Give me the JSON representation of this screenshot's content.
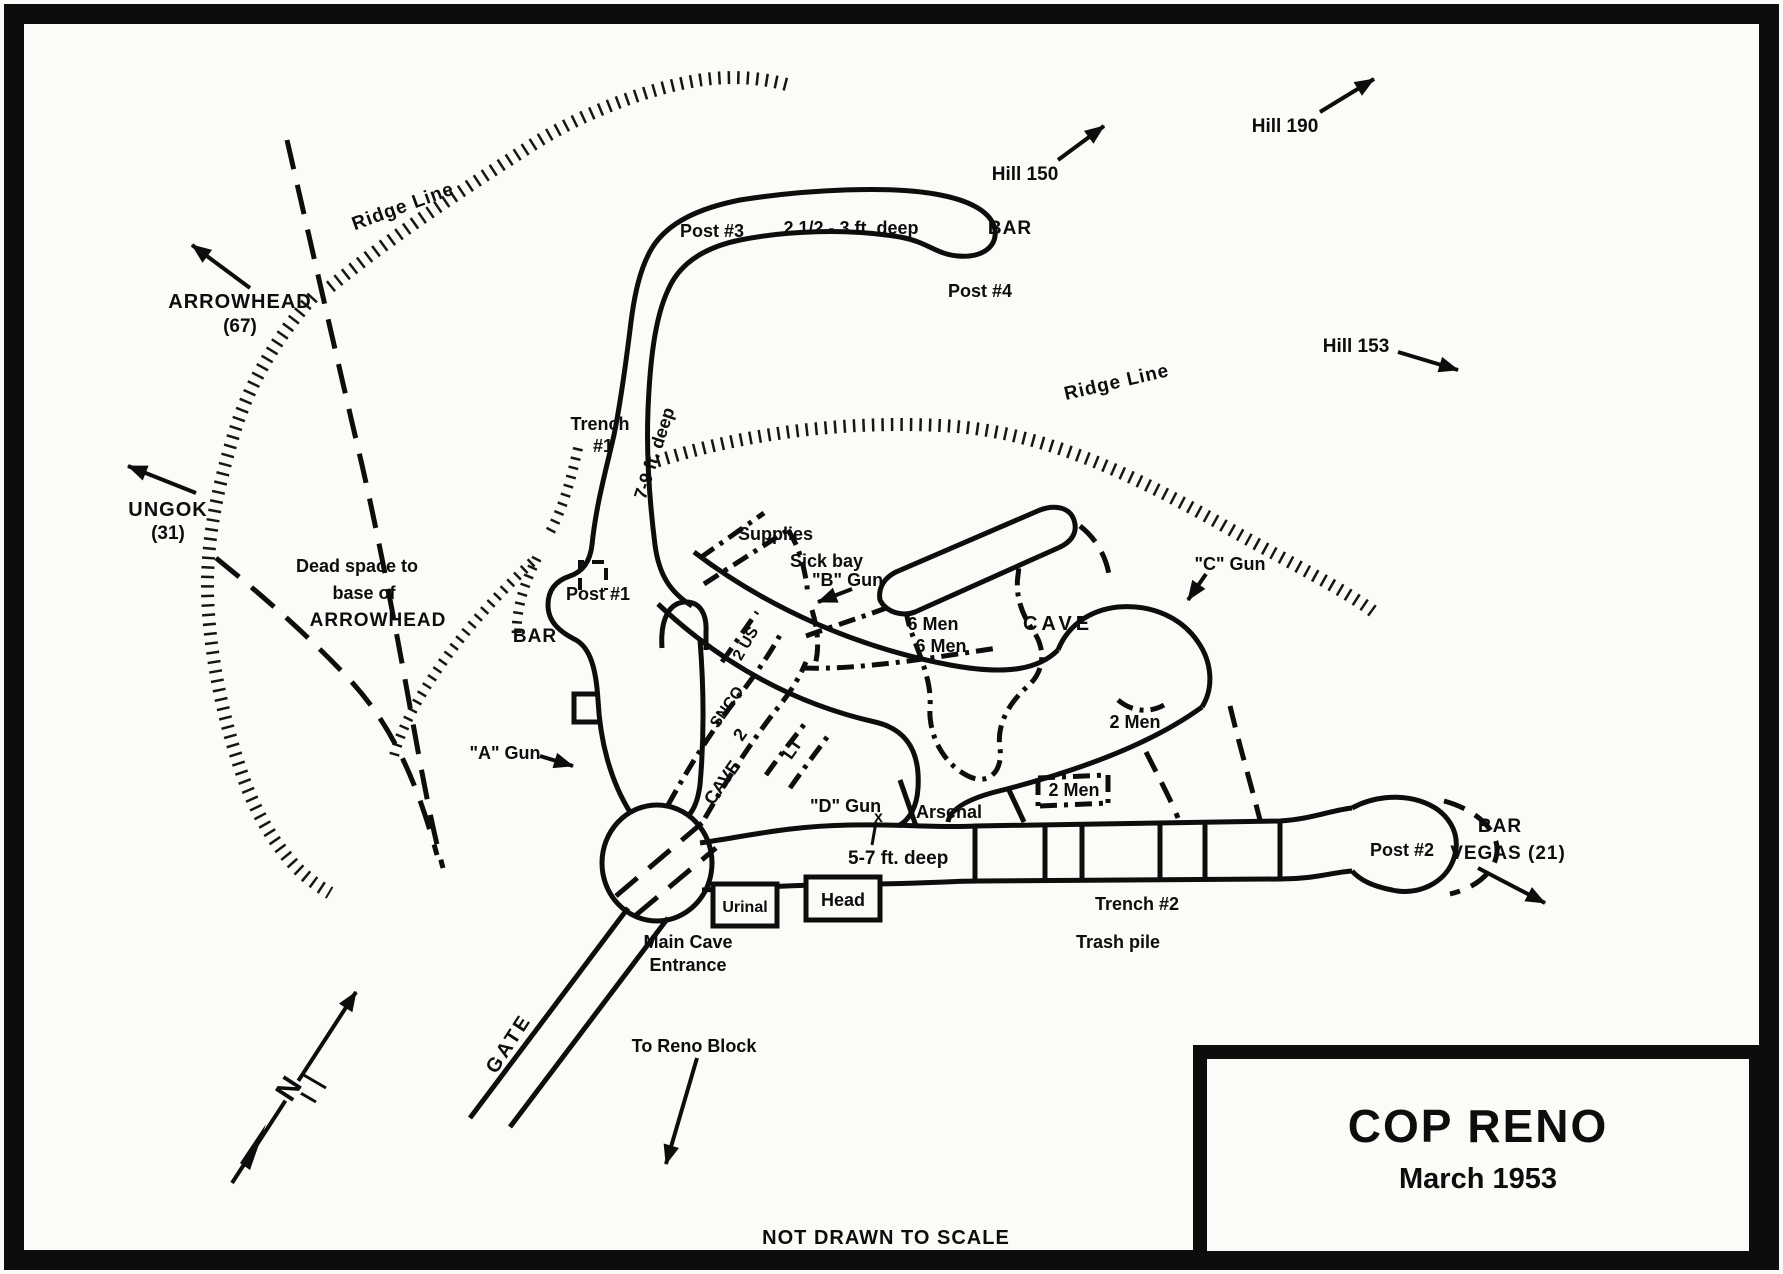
{
  "map": {
    "title": "COP RENO",
    "subtitle": "March 1953",
    "footer": "NOT DRAWN TO SCALE",
    "colors": {
      "ink": "#0d0d0d",
      "paper": "#fbfbf8"
    }
  },
  "labels": {
    "ridge_line_left": "Ridge Line",
    "ridge_line_right": "Ridge Line",
    "arrowhead": "ARROWHEAD",
    "arrowhead_num": "(67)",
    "ungok": "UNGOK",
    "ungok_num": "(31)",
    "hill_150": "Hill 150",
    "hill_190": "Hill 190",
    "hill_153": "Hill 153",
    "dead_space_1": "Dead space to",
    "dead_space_2": "base of",
    "dead_space_3": "ARROWHEAD",
    "trench1_a": "Trench",
    "trench1_b": "#1",
    "trench1_depth": "7-9 ft. deep",
    "top_depth": "2 1/2 - 3 ft. deep",
    "main_depth": "5-7 ft. deep",
    "post1": "Post #1",
    "post2": "Post #2",
    "post3": "Post #3",
    "post4": "Post #4",
    "bar_left": "BAR",
    "bar_top": "BAR",
    "bar_vegas_1": "BAR",
    "bar_vegas_2": "VEGAS (21)",
    "supplies": "Supplies",
    "sick_bay": "Sick bay",
    "a_gun": "\"A\" Gun",
    "b_gun": "\"B\" Gun",
    "c_gun": "\"C\" Gun",
    "d_gun": "\"D\" Gun",
    "d_gun_x": "x",
    "six_men_a": "6 Men",
    "six_men_b": "6 Men",
    "two_men_a": "2 Men",
    "two_men_b": "2 Men",
    "cave_big": "CAVE",
    "cave_tunnel": "CAVE",
    "cave_tunnel_num": "2",
    "snco": "SNCO",
    "two_us": "2 US",
    "lt": "LT",
    "arsenal": "Arsenal",
    "urinal": "Urinal",
    "head": "Head",
    "main_cave_1": "Main Cave",
    "main_cave_2": "Entrance",
    "trench2": "Trench #2",
    "trash_pile": "Trash pile",
    "gate": "GATE",
    "to_reno_block": "To Reno Block",
    "north": "N"
  }
}
